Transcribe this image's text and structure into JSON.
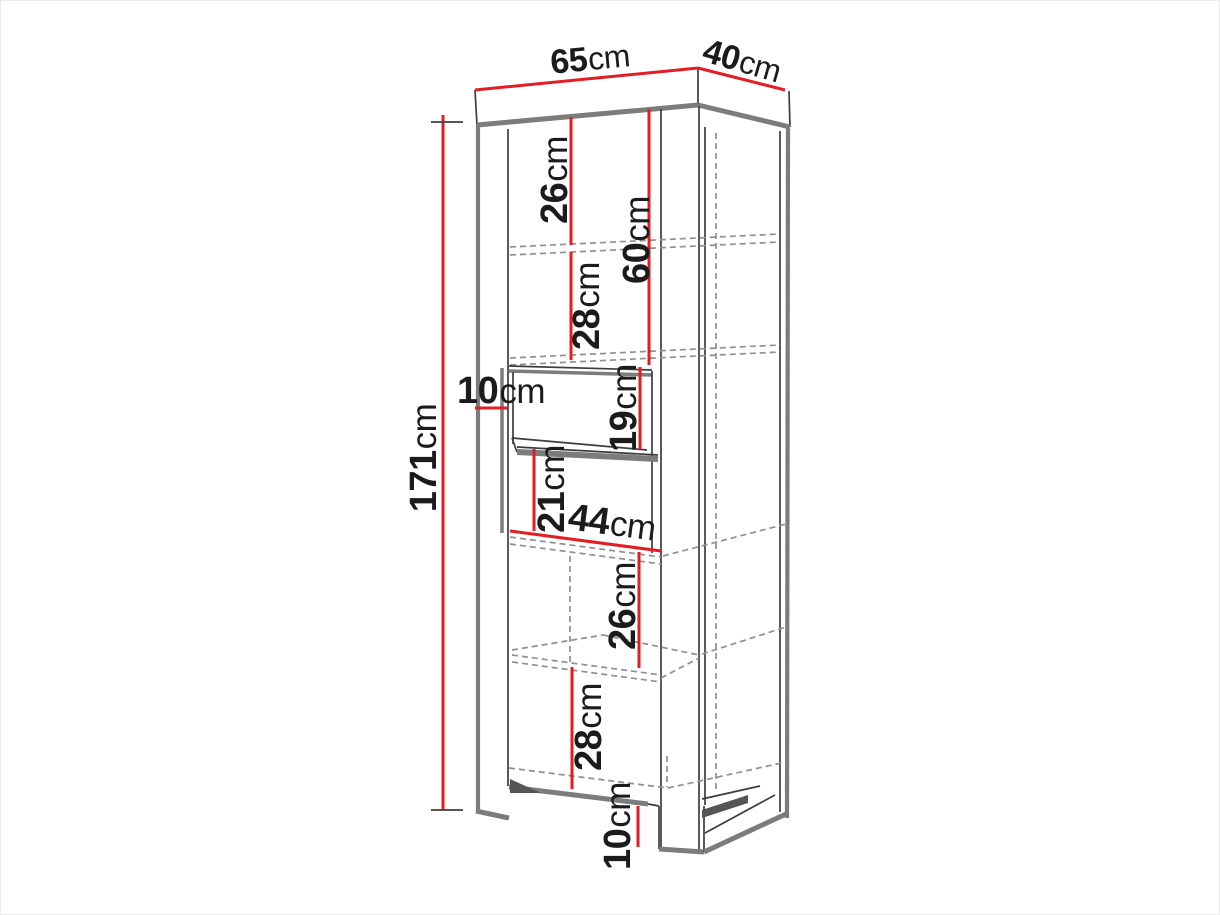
{
  "diagram_type": "furniture-dimension-drawing",
  "unit": "cm",
  "colors": {
    "dimension_red": "#e41c23",
    "edge_dark": "#3d3d3d",
    "edge_gray": "#7c7c7c",
    "hidden_gray": "#909090",
    "shadow_gray": "#555555",
    "text_black": "#1b1b1b",
    "background": "#ffffff"
  },
  "dims": {
    "top_width": {
      "value": "65",
      "unit": "cm"
    },
    "top_depth": {
      "value": "40",
      "unit": "cm"
    },
    "total_height": {
      "value": "171",
      "unit": "cm"
    },
    "upper_compartment": {
      "value": "26",
      "unit": "cm"
    },
    "upper_section": {
      "value": "60",
      "unit": "cm"
    },
    "second_compartment": {
      "value": "28",
      "unit": "cm"
    },
    "wall_depth": {
      "value": "10",
      "unit": "cm"
    },
    "niche_upper": {
      "value": "19",
      "unit": "cm"
    },
    "niche_lower": {
      "value": "21",
      "unit": "cm"
    },
    "inner_width": {
      "value": "44",
      "unit": "cm"
    },
    "lower_compartment": {
      "value": "26",
      "unit": "cm"
    },
    "bottom_compartment": {
      "value": "28",
      "unit": "cm"
    },
    "plinth_height": {
      "value": "10",
      "unit": "cm"
    }
  }
}
